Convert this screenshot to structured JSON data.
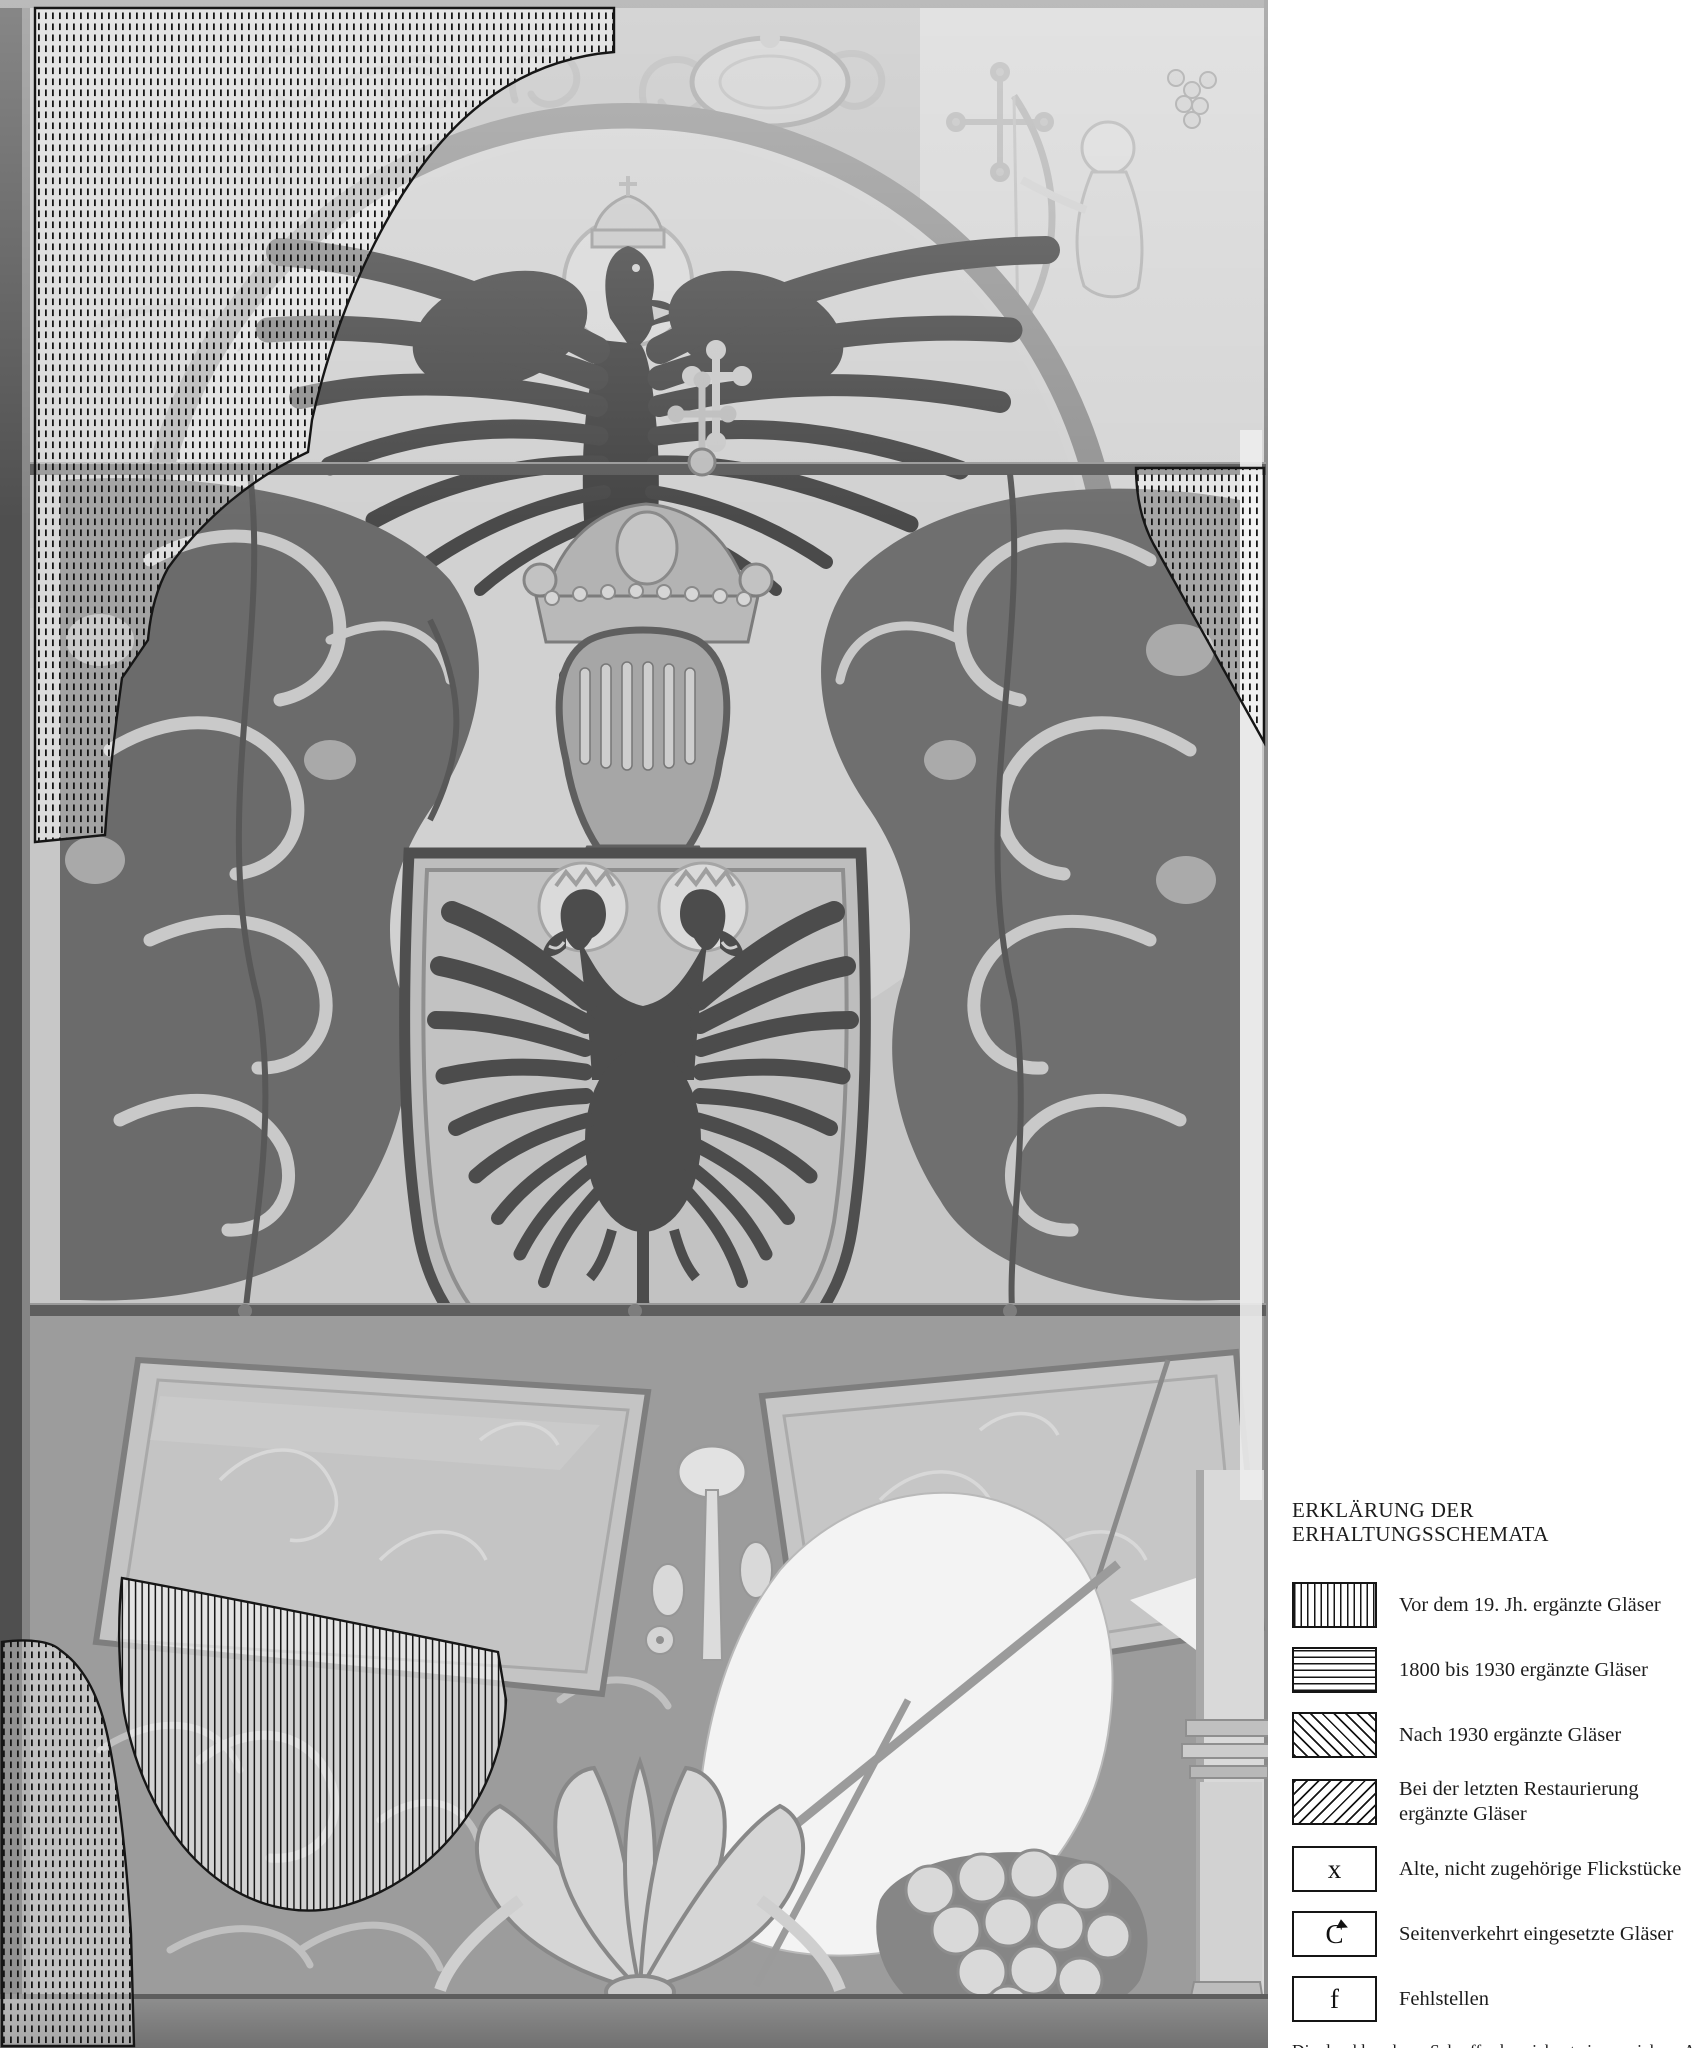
{
  "legend": {
    "title": "ERKLÄRUNG DER ERHALTUNGSSCHEMATA",
    "items": [
      {
        "pattern": "vertical-hatch",
        "label": "Vor dem 19. Jh. ergänzte Gläser"
      },
      {
        "pattern": "horizontal-hatch",
        "label": "1800 bis 1930 ergänzte Gläser"
      },
      {
        "pattern": "diagonal-hatch-back",
        "label": "Nach 1930 ergänzte Gläser"
      },
      {
        "pattern": "diagonal-hatch-forward",
        "label": "Bei der letzten Restaurierung ergänzte Gläser"
      },
      {
        "pattern": "symbol",
        "symbol": "x",
        "label": "Alte, nicht zugehörige Flickstücke"
      },
      {
        "pattern": "symbol",
        "symbol": "C",
        "label": "Seitenverkehrt eingesetzte Gläser"
      },
      {
        "pattern": "symbol",
        "symbol": "f",
        "label": "Fehlstellen"
      }
    ],
    "footnote": "Die durchbrochene Schraffur bezeichnet eine unsichere Angabe"
  },
  "figure": {
    "type": "stained-glass-conservation-photograph",
    "overlays": [
      {
        "id": "upper-left-spandrel-and-left-border",
        "hatch": "vertical-broken"
      },
      {
        "id": "right-border-middle",
        "hatch": "vertical-broken"
      },
      {
        "id": "lower-left-border",
        "hatch": "vertical-broken"
      },
      {
        "id": "lower-left-half-disc",
        "hatch": "vertical-solid"
      }
    ]
  },
  "colors": {
    "page_bg": "#ffffff",
    "photo_base": "#c7c7c7",
    "hatch_ink": "#151515",
    "lead_line": "#4f4f4f",
    "text_ink": "#1c1c1c"
  }
}
